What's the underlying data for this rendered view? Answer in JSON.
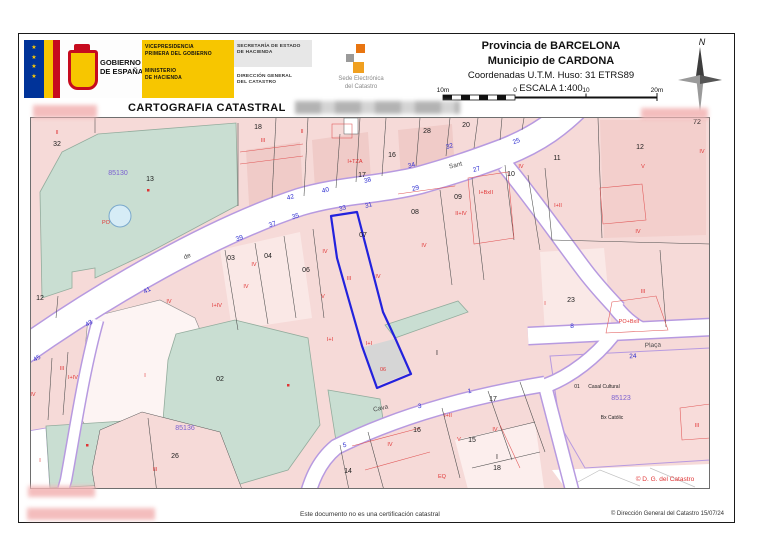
{
  "header": {
    "gobierno": {
      "line1": "GOBIERNO",
      "line2": "DE ESPAÑA"
    },
    "ministry": {
      "l1": "VICEPRESIDENCIA",
      "l2": "PRIMERA DEL GOBIERNO",
      "l3": "MINISTERIO",
      "l4": "DE HACIENDA"
    },
    "secretaria": {
      "l1": "SECRETARÍA DE ESTADO",
      "l2": "DE HACIENDA"
    },
    "direccion": {
      "l1": "DIRECCIÓN GENERAL",
      "l2": "DEL CATASTRO"
    },
    "sede": {
      "l1": "Sede Electrónica",
      "l2": "del Catastro"
    },
    "province": "Provincia de BARCELONA",
    "municipality": "Municipio de CARDONA",
    "coordinates": "Coordenadas U.T.M. Huso: 31 ETRS89",
    "scale": "ESCALA 1:400",
    "scalebar": {
      "labels": [
        "10m",
        "0",
        "10",
        "20m"
      ]
    },
    "north": "N",
    "map_title": "CARTOGRAFIA CATASTRAL"
  },
  "footer": {
    "disclaimer": "Este documento no es una certificación catastral",
    "copyright": "© Dirección General del Catastro 15/07/24"
  },
  "colors": {
    "parcel_pink": "#f6dad8",
    "garden_green": "#c9ded2",
    "street_edge_purple": "#b79ae0",
    "selected_blue": "#2222dd",
    "house_number_blue": "#2b2bd0",
    "construction_red": "#e03535",
    "block_purple": "#7a5fd0",
    "ministry_yellow": "#f7c600"
  },
  "map": {
    "copyright_inner": "© D. G. del Catastro",
    "block_numbers": [
      "85130",
      "85136",
      "85123"
    ],
    "street_names": [
      "Sant",
      "de",
      "Cava",
      "Plaça"
    ],
    "labels": [
      {
        "t": "32",
        "x": 57,
        "y": 146,
        "c": "k"
      },
      {
        "t": "13",
        "x": 150,
        "y": 181,
        "c": "k"
      },
      {
        "t": "18",
        "x": 258,
        "y": 129,
        "c": "k"
      },
      {
        "t": "16",
        "x": 392,
        "y": 157,
        "c": "k"
      },
      {
        "t": "17",
        "x": 362,
        "y": 177,
        "c": "k"
      },
      {
        "t": "28",
        "x": 427,
        "y": 133,
        "c": "k"
      },
      {
        "t": "20",
        "x": 466,
        "y": 127,
        "c": "k"
      },
      {
        "t": "12",
        "x": 40,
        "y": 300,
        "c": "k"
      },
      {
        "t": "03",
        "x": 231,
        "y": 260,
        "c": "k"
      },
      {
        "t": "04",
        "x": 268,
        "y": 258,
        "c": "k"
      },
      {
        "t": "06",
        "x": 306,
        "y": 272,
        "c": "k"
      },
      {
        "t": "07",
        "x": 363,
        "y": 237,
        "c": "k"
      },
      {
        "t": "08",
        "x": 415,
        "y": 214,
        "c": "k"
      },
      {
        "t": "09",
        "x": 458,
        "y": 199,
        "c": "k"
      },
      {
        "t": "10",
        "x": 511,
        "y": 176,
        "c": "k"
      },
      {
        "t": "11",
        "x": 557,
        "y": 160,
        "c": "k"
      },
      {
        "t": "12",
        "x": 640,
        "y": 149,
        "c": "k"
      },
      {
        "t": "72",
        "x": 697,
        "y": 124,
        "c": "k"
      },
      {
        "t": "23",
        "x": 571,
        "y": 302,
        "c": "k"
      },
      {
        "t": "02",
        "x": 220,
        "y": 381,
        "c": "k"
      },
      {
        "t": "26",
        "x": 175,
        "y": 458,
        "c": "k"
      },
      {
        "t": "01",
        "x": 577,
        "y": 388,
        "c": "s"
      },
      {
        "t": "14",
        "x": 348,
        "y": 473,
        "c": "k"
      },
      {
        "t": "16",
        "x": 417,
        "y": 432,
        "c": "k"
      },
      {
        "t": "17",
        "x": 493,
        "y": 401,
        "c": "k"
      },
      {
        "t": "15",
        "x": 472,
        "y": 442,
        "c": "k"
      },
      {
        "t": "18",
        "x": 497,
        "y": 470,
        "c": "k"
      },
      {
        "t": "I",
        "x": 437,
        "y": 355,
        "c": "k"
      },
      {
        "t": "I",
        "x": 497,
        "y": 459,
        "c": "k"
      },
      {
        "t": "42",
        "x": 291,
        "y": 199,
        "c": "b",
        "r": -15
      },
      {
        "t": "40",
        "x": 326,
        "y": 192,
        "c": "b",
        "r": -15
      },
      {
        "t": "38",
        "x": 368,
        "y": 182,
        "c": "b",
        "r": -15
      },
      {
        "t": "34",
        "x": 412,
        "y": 167,
        "c": "b",
        "r": -15
      },
      {
        "t": "32",
        "x": 450,
        "y": 148,
        "c": "b",
        "r": -15
      },
      {
        "t": "25",
        "x": 517,
        "y": 143,
        "c": "b",
        "r": -20
      },
      {
        "t": "27",
        "x": 477,
        "y": 171,
        "c": "b",
        "r": -15
      },
      {
        "t": "35",
        "x": 296,
        "y": 218,
        "c": "b",
        "r": -15
      },
      {
        "t": "33",
        "x": 343,
        "y": 210,
        "c": "b",
        "r": -15
      },
      {
        "t": "31",
        "x": 369,
        "y": 207,
        "c": "b",
        "r": -15
      },
      {
        "t": "29",
        "x": 416,
        "y": 190,
        "c": "b",
        "r": -15
      },
      {
        "t": "39",
        "x": 240,
        "y": 240,
        "c": "b",
        "r": -18
      },
      {
        "t": "37",
        "x": 273,
        "y": 226,
        "c": "b",
        "r": -18
      },
      {
        "t": "41",
        "x": 148,
        "y": 292,
        "c": "b",
        "r": -28
      },
      {
        "t": "43",
        "x": 90,
        "y": 325,
        "c": "b",
        "r": -32
      },
      {
        "t": "45",
        "x": 38,
        "y": 360,
        "c": "b",
        "r": -32
      },
      {
        "t": "24",
        "x": 633,
        "y": 358,
        "c": "b",
        "r": -3
      },
      {
        "t": "8",
        "x": 572,
        "y": 328,
        "c": "b"
      },
      {
        "t": "5",
        "x": 345,
        "y": 447,
        "c": "b",
        "r": -12
      },
      {
        "t": "3",
        "x": 420,
        "y": 408,
        "c": "b",
        "r": -12
      },
      {
        "t": "1",
        "x": 470,
        "y": 393,
        "c": "b",
        "r": -12
      },
      {
        "t": "II",
        "x": 57,
        "y": 134,
        "c": "r"
      },
      {
        "t": "III",
        "x": 263,
        "y": 142,
        "c": "r"
      },
      {
        "t": "PO",
        "x": 106,
        "y": 224,
        "c": "r"
      },
      {
        "t": "I+TZA",
        "x": 355,
        "y": 163,
        "c": "r"
      },
      {
        "t": "II",
        "x": 302,
        "y": 133,
        "c": "r"
      },
      {
        "t": "IV",
        "x": 254,
        "y": 266,
        "c": "r"
      },
      {
        "t": "IV",
        "x": 325,
        "y": 253,
        "c": "r"
      },
      {
        "t": "III",
        "x": 349,
        "y": 280,
        "c": "r"
      },
      {
        "t": "IV",
        "x": 378,
        "y": 278,
        "c": "r"
      },
      {
        "t": "IV",
        "x": 424,
        "y": 247,
        "c": "r"
      },
      {
        "t": "V",
        "x": 323,
        "y": 298,
        "c": "r"
      },
      {
        "t": "II+IV",
        "x": 461,
        "y": 215,
        "c": "r"
      },
      {
        "t": "I+BxII",
        "x": 486,
        "y": 194,
        "c": "r"
      },
      {
        "t": "IV",
        "x": 521,
        "y": 168,
        "c": "r"
      },
      {
        "t": "I+II",
        "x": 558,
        "y": 207,
        "c": "r"
      },
      {
        "t": "V",
        "x": 643,
        "y": 168,
        "c": "r"
      },
      {
        "t": "IV",
        "x": 702,
        "y": 153,
        "c": "r"
      },
      {
        "t": "IV",
        "x": 638,
        "y": 233,
        "c": "r"
      },
      {
        "t": "I+I",
        "x": 330,
        "y": 341,
        "c": "r"
      },
      {
        "t": "I+I",
        "x": 369,
        "y": 345,
        "c": "r"
      },
      {
        "t": "06",
        "x": 383,
        "y": 371,
        "c": "r"
      },
      {
        "t": "IV",
        "x": 169,
        "y": 303,
        "c": "r"
      },
      {
        "t": "I+IV",
        "x": 217,
        "y": 307,
        "c": "r"
      },
      {
        "t": "IV",
        "x": 246,
        "y": 288,
        "c": "r"
      },
      {
        "t": "III",
        "x": 62,
        "y": 370,
        "c": "r"
      },
      {
        "t": "I+IV",
        "x": 73,
        "y": 379,
        "c": "r"
      },
      {
        "t": "IV",
        "x": 33,
        "y": 396,
        "c": "r"
      },
      {
        "t": "I",
        "x": 145,
        "y": 377,
        "c": "r"
      },
      {
        "t": "I",
        "x": 40,
        "y": 462,
        "c": "r"
      },
      {
        "t": "III",
        "x": 155,
        "y": 471,
        "c": "r"
      },
      {
        "t": "IV",
        "x": 390,
        "y": 446,
        "c": "r"
      },
      {
        "t": "I+II",
        "x": 448,
        "y": 417,
        "c": "r"
      },
      {
        "t": "V",
        "x": 459,
        "y": 441,
        "c": "r"
      },
      {
        "t": "IV",
        "x": 495,
        "y": 431,
        "c": "r"
      },
      {
        "t": "EQ",
        "x": 442,
        "y": 478,
        "c": "r"
      },
      {
        "t": "I",
        "x": 545,
        "y": 305,
        "c": "r"
      },
      {
        "t": "PO+BxII",
        "x": 629,
        "y": 323,
        "c": "r"
      },
      {
        "t": "III",
        "x": 643,
        "y": 293,
        "c": "r"
      },
      {
        "t": "III",
        "x": 697,
        "y": 427,
        "c": "r"
      },
      {
        "t": "85130",
        "x": 118,
        "y": 175,
        "c": "p"
      },
      {
        "t": "85136",
        "x": 185,
        "y": 430,
        "c": "p"
      },
      {
        "t": "85123",
        "x": 621,
        "y": 400,
        "c": "p"
      },
      {
        "t": "Sant",
        "x": 456,
        "y": 167,
        "c": "n",
        "r": -14
      },
      {
        "t": "de",
        "x": 188,
        "y": 258,
        "c": "n",
        "r": -24
      },
      {
        "t": "Cava",
        "x": 381,
        "y": 410,
        "c": "n",
        "r": -12
      },
      {
        "t": "Plaça",
        "x": 653,
        "y": 347,
        "c": "n",
        "r": -3
      },
      {
        "t": "Casal Cultural",
        "x": 604,
        "y": 388,
        "c": "s"
      },
      {
        "t": "Bx Católic",
        "x": 612,
        "y": 419,
        "c": "s"
      },
      {
        "t": "© D. G. del Catastro",
        "x": 665,
        "y": 481,
        "c": "c"
      }
    ]
  }
}
